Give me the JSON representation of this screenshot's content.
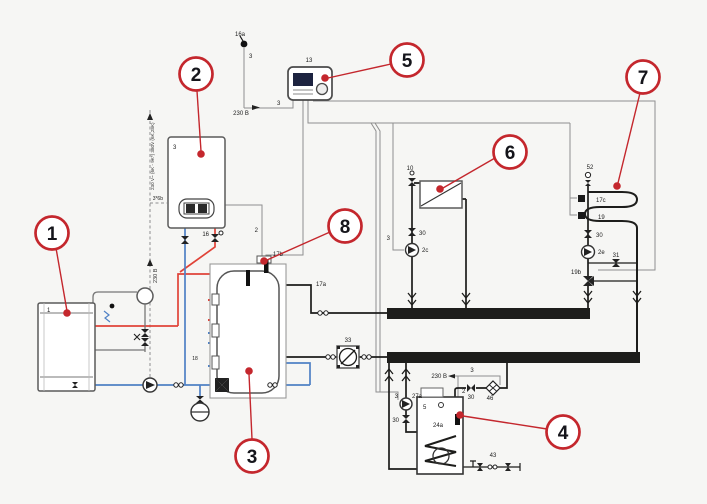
{
  "title": "heating-system-hydraulic-schematic",
  "colors": {
    "background": "#f6f6f4",
    "callout_red": "#c4272d",
    "pipe_red": "#e04338",
    "pipe_blue": "#4f81c5",
    "pipe_black": "#1d1d1b",
    "wire_grey": "#8f8f8f"
  },
  "callouts": {
    "c1": "1",
    "c2": "2",
    "c3": "3",
    "c4": "4",
    "c5": "5",
    "c6": "6",
    "c7": "7",
    "c8": "8"
  },
  "labels": {
    "unit1_id": "1",
    "boiler_id": "3",
    "boiler_power_vert": "230 V~ (6K - 9K*) 380V (6K,28K)",
    "boiler_fuse": "3*6b",
    "power_left_vert": "230 B",
    "safety_valve_16": "16",
    "wire2_boiler": "2",
    "sensor_16a": "16a",
    "wire3_16a": "3",
    "controller_id": "13",
    "power_controller": "230 B",
    "wire3_controller": "3",
    "tank_sensor_17b": "17b",
    "pipe_17a": "17a",
    "hx_33": "33",
    "label_18": "18",
    "rad_valve_10": "10",
    "rad_valve_30": "30",
    "rad_pump_2c": "2c",
    "rad_wire_3": "3",
    "floor_vent_52": "52",
    "floor_sensor_17c": "17c",
    "floor_sensor_19": "19",
    "floor_valve_30": "30",
    "floor_pump_2e": "2e",
    "floor_valve_31": "31",
    "floor_mix_19b": "19b",
    "dhw_power": "230 B",
    "dhw_wire_3": "3",
    "dhw_wire_2": "2",
    "dhw_pump_27a": "27a",
    "dhw_wire3_27a": "3",
    "dhw_valve_30": "30",
    "dhw_out_valve_30": "30",
    "dhw_circ_pump_46": "46",
    "dhw_tank_5": "5",
    "dhw_sensor_24a": "24a",
    "dhw_inlet_43": "43"
  }
}
